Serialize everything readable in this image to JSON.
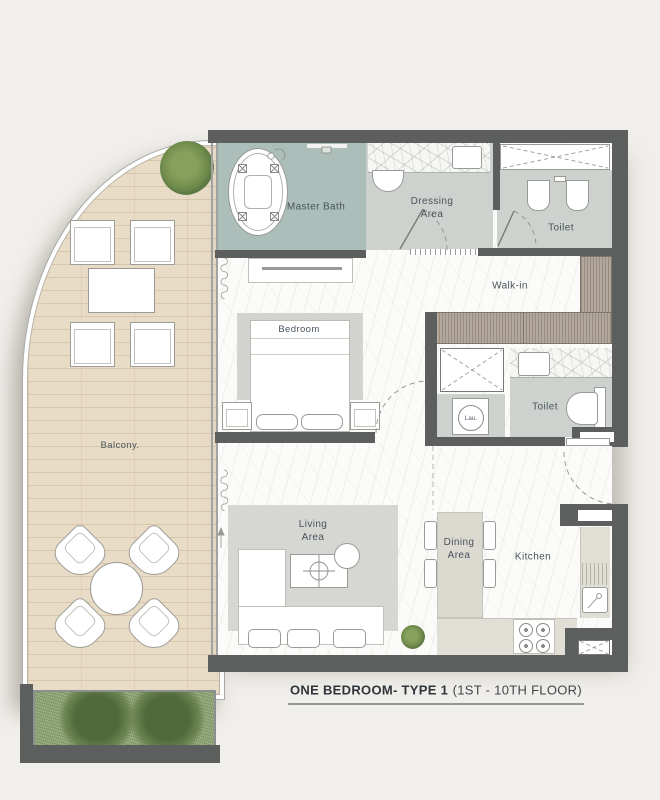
{
  "plan": {
    "rooms": {
      "master_bath": "Master Bath",
      "dressing": "Dressing\nArea",
      "toilet_master": "Toilet",
      "walk_in": "Walk-in",
      "bedroom": "Bedroom",
      "toilet_guest": "Toilet",
      "laundry": "Lau.",
      "living": "Living\nArea",
      "dining": "Dining\nArea",
      "kitchen": "Kitchen",
      "balcony": "Balcony."
    },
    "title": {
      "name": "ONE BEDROOM- TYPE 1",
      "floors": "(1ST - 10TH FLOOR)"
    },
    "colors": {
      "background": "#f1efeb",
      "wall": "#5d5f5f",
      "master_bath_floor": "#abbeba",
      "bath_tile_floor": "#ced2ce",
      "balcony_wood": "#e9dcc7",
      "wardrobe_wood": "#b2a89c",
      "kitchen_counter": "#e1ded5",
      "rug": "#d6d7d3",
      "greenery": "#7d9560",
      "label_text": "#49545c"
    }
  }
}
